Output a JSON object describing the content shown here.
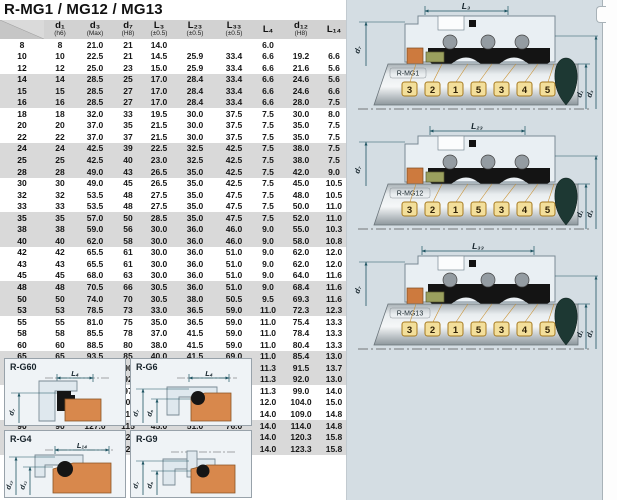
{
  "title": "R-MG1 / MG12 / MG13",
  "table": {
    "headers": [
      {
        "m": "",
        "s": ""
      },
      {
        "m": "d₁",
        "s": "(h6)"
      },
      {
        "m": "d₃",
        "s": "(Max)"
      },
      {
        "m": "d₇",
        "s": "(H8)"
      },
      {
        "m": "L₃",
        "s": "(±0.5)"
      },
      {
        "m": "L₂₃",
        "s": "(±0.5)"
      },
      {
        "m": "L₃₃",
        "s": "(±0.5)"
      },
      {
        "m": "L₄",
        "s": ""
      },
      {
        "m": "d₁₂",
        "s": "(H8)"
      },
      {
        "m": "L₁₄",
        "s": ""
      }
    ],
    "rows": [
      [
        "8",
        "8",
        "21.0",
        "21",
        "14.0",
        "",
        "",
        "6.0",
        "",
        ""
      ],
      [
        "10",
        "10",
        "22.5",
        "21",
        "14.5",
        "25.9",
        "33.4",
        "6.6",
        "19.2",
        "6.6"
      ],
      [
        "12",
        "12",
        "25.0",
        "23",
        "15.0",
        "25.9",
        "33.4",
        "6.6",
        "21.6",
        "5.6"
      ],
      [
        "14",
        "14",
        "28.5",
        "25",
        "17.0",
        "28.4",
        "33.4",
        "6.6",
        "24.6",
        "5.6"
      ],
      [
        "15",
        "15",
        "28.5",
        "27",
        "17.0",
        "28.4",
        "33.4",
        "6.6",
        "24.6",
        "6.6"
      ],
      [
        "16",
        "16",
        "28.5",
        "27",
        "17.0",
        "28.4",
        "33.4",
        "6.6",
        "28.0",
        "7.5"
      ],
      [
        "18",
        "18",
        "32.0",
        "33",
        "19.5",
        "30.0",
        "37.5",
        "7.5",
        "30.0",
        "8.0"
      ],
      [
        "20",
        "20",
        "37.0",
        "35",
        "21.5",
        "30.0",
        "37.5",
        "7.5",
        "35.0",
        "7.5"
      ],
      [
        "22",
        "22",
        "37.0",
        "37",
        "21.5",
        "30.0",
        "37.5",
        "7.5",
        "35.0",
        "7.5"
      ],
      [
        "24",
        "24",
        "42.5",
        "39",
        "22.5",
        "32.5",
        "42.5",
        "7.5",
        "38.0",
        "7.5"
      ],
      [
        "25",
        "25",
        "42.5",
        "40",
        "23.0",
        "32.5",
        "42.5",
        "7.5",
        "38.0",
        "7.5"
      ],
      [
        "28",
        "28",
        "49.0",
        "43",
        "26.5",
        "35.0",
        "42.5",
        "7.5",
        "42.0",
        "9.0"
      ],
      [
        "30",
        "30",
        "49.0",
        "45",
        "26.5",
        "35.0",
        "42.5",
        "7.5",
        "45.0",
        "10.5"
      ],
      [
        "32",
        "32",
        "53.5",
        "48",
        "27.5",
        "35.0",
        "47.5",
        "7.5",
        "48.0",
        "10.5"
      ],
      [
        "33",
        "33",
        "53.5",
        "48",
        "27.5",
        "35.0",
        "47.5",
        "7.5",
        "50.0",
        "11.0"
      ],
      [
        "35",
        "35",
        "57.0",
        "50",
        "28.5",
        "35.0",
        "47.5",
        "7.5",
        "52.0",
        "11.0"
      ],
      [
        "38",
        "38",
        "59.0",
        "56",
        "30.0",
        "36.0",
        "46.0",
        "9.0",
        "55.0",
        "10.3"
      ],
      [
        "40",
        "40",
        "62.0",
        "58",
        "30.0",
        "36.0",
        "46.0",
        "9.0",
        "58.0",
        "10.8"
      ],
      [
        "42",
        "42",
        "65.5",
        "61",
        "30.0",
        "36.0",
        "51.0",
        "9.0",
        "62.0",
        "12.0"
      ],
      [
        "43",
        "43",
        "65.5",
        "61",
        "30.0",
        "36.0",
        "51.0",
        "9.0",
        "62.0",
        "12.0"
      ],
      [
        "45",
        "45",
        "68.0",
        "63",
        "30.0",
        "36.0",
        "51.0",
        "9.0",
        "64.0",
        "11.6"
      ],
      [
        "48",
        "48",
        "70.5",
        "66",
        "30.5",
        "36.0",
        "51.0",
        "9.0",
        "68.4",
        "11.6"
      ],
      [
        "50",
        "50",
        "74.0",
        "70",
        "30.5",
        "38.0",
        "50.5",
        "9.5",
        "69.3",
        "11.6"
      ],
      [
        "53",
        "53",
        "78.5",
        "73",
        "33.0",
        "36.5",
        "59.0",
        "11.0",
        "72.3",
        "12.3"
      ],
      [
        "55",
        "55",
        "81.0",
        "75",
        "35.0",
        "36.5",
        "59.0",
        "11.0",
        "75.4",
        "13.3"
      ],
      [
        "58",
        "58",
        "85.5",
        "78",
        "37.0",
        "41.5",
        "59.0",
        "11.0",
        "78.4",
        "13.3"
      ],
      [
        "60",
        "60",
        "88.5",
        "80",
        "38.0",
        "41.5",
        "59.0",
        "11.0",
        "80.4",
        "13.3"
      ],
      [
        "65",
        "65",
        "93.5",
        "85",
        "40.0",
        "41.5",
        "69.0",
        "11.0",
        "85.4",
        "13.0"
      ],
      [
        "68",
        "68",
        "96.5",
        "90",
        "40.0",
        "41.2",
        "68.7",
        "11.3",
        "91.5",
        "13.7"
      ],
      [
        "70",
        "70",
        "99.5",
        "92",
        "40.0",
        "48.7",
        "68.7",
        "11.3",
        "92.0",
        "13.0"
      ],
      [
        "75",
        "75",
        "107.0",
        "97",
        "40.0",
        "48.7",
        "68.7",
        "11.3",
        "99.0",
        "14.0"
      ],
      [
        "80",
        "80",
        "112.0",
        "105",
        "40.0",
        "48.0",
        "78.0",
        "12.0",
        "104.0",
        "15.0"
      ],
      [
        "85",
        "85",
        "120.0",
        "110",
        "41.0",
        "46.0",
        "76.0",
        "14.0",
        "109.0",
        "14.8"
      ],
      [
        "90",
        "90",
        "127.0",
        "115",
        "45.0",
        "51.0",
        "76.0",
        "14.0",
        "114.0",
        "14.8"
      ],
      [
        "95",
        "95",
        "132.0",
        "120",
        "46.0",
        "51.0",
        "76.0",
        "14.0",
        "120.3",
        "15.8"
      ],
      [
        "100",
        "100",
        "137.0",
        "125",
        "47.0",
        "51.0",
        "76.0",
        "14.0",
        "123.3",
        "15.8"
      ]
    ]
  },
  "diagrams": [
    {
      "label": "R-MG1",
      "dim_top": "L₃",
      "dim_left": "d₇",
      "dim_inner": "d₁",
      "dim_outer": "d₃",
      "callouts": [
        "3",
        "2",
        "1",
        "5",
        "3",
        "4",
        "5"
      ]
    },
    {
      "label": "R-MG12",
      "dim_top": "L₂₃",
      "dim_left": "d₇",
      "dim_inner": "d₁",
      "dim_outer": "d₃",
      "callouts": [
        "3",
        "2",
        "1",
        "5",
        "3",
        "4",
        "5"
      ]
    },
    {
      "label": "R-MG13",
      "dim_top": "L₃₃",
      "dim_left": "d₇",
      "dim_inner": "d₁",
      "dim_outer": "d₃",
      "callouts": [
        "3",
        "2",
        "1",
        "5",
        "3",
        "4",
        "5"
      ]
    }
  ],
  "detail_panels": [
    {
      "label": "R-G60",
      "dim_top": "L₄",
      "dim_left1": "d₇",
      "dim_left2": ""
    },
    {
      "label": "R-G6",
      "dim_top": "L₄",
      "dim_left1": "d₇",
      "dim_left2": "d₆"
    },
    {
      "label": "R-G4",
      "dim_top": "L₁₄",
      "dim_left1": "d₁₂",
      "dim_left2": "d₁₁"
    },
    {
      "label": "R-G9",
      "dim_top": "",
      "dim_left1": "d₇",
      "dim_left2": "d₆"
    }
  ],
  "colors": {
    "panel_bg": "#d4dde3",
    "row_shade": "#d9d9d9",
    "header_bg": "#d2d2d2",
    "seal_orange": "#cd7a3e",
    "seal_olive": "#9aa05e",
    "callout_fill": "#f3df9b",
    "callout_border": "#a5791f",
    "teardrop": "#1d3833",
    "dim_line": "#1f5563"
  }
}
